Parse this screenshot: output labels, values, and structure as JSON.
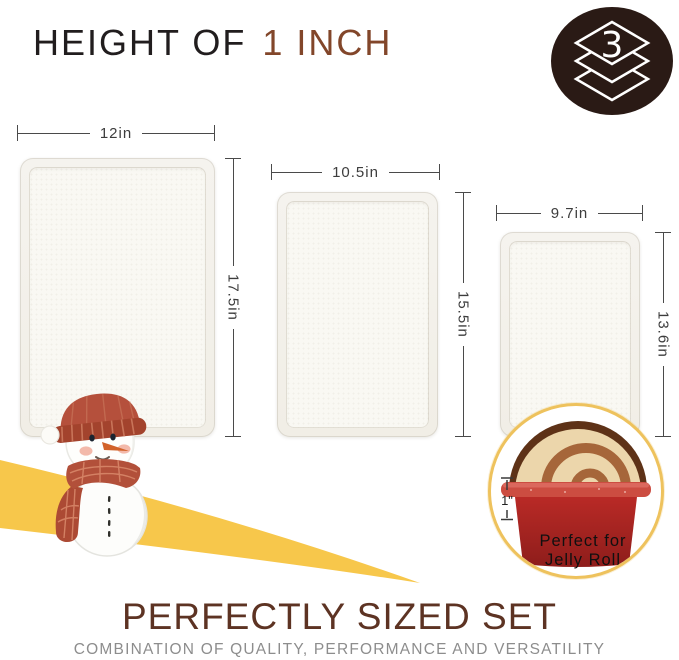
{
  "header": {
    "title_black": "HEIGHT OF",
    "title_brown": "1 INCH"
  },
  "badge": {
    "count": "3",
    "bg_color": "#2a1a15",
    "icon": "stacked-layers-icon"
  },
  "trays": [
    {
      "width_label": "12in",
      "height_label": "17.5in"
    },
    {
      "width_label": "10.5in",
      "height_label": "15.5in"
    },
    {
      "width_label": "9.7in",
      "height_label": "13.6in"
    }
  ],
  "inset": {
    "height_label": "1\"",
    "caption_line1": "Perfect for",
    "caption_line2": "Jelly Roll"
  },
  "footer": {
    "title": "PERFECTLY SIZED SET",
    "subtitle": "COMBINATION OF QUALITY, PERFORMANCE AND VERSATILITY"
  },
  "colors": {
    "accent_yellow": "#f7c74b",
    "title_brown": "#82462a",
    "footer_brown": "#5d3323",
    "tray_surface": "#f5f3ee",
    "pan_red": "#b92a26",
    "gold_ring": "#eec25d",
    "snowman_red": "#b5503c"
  }
}
